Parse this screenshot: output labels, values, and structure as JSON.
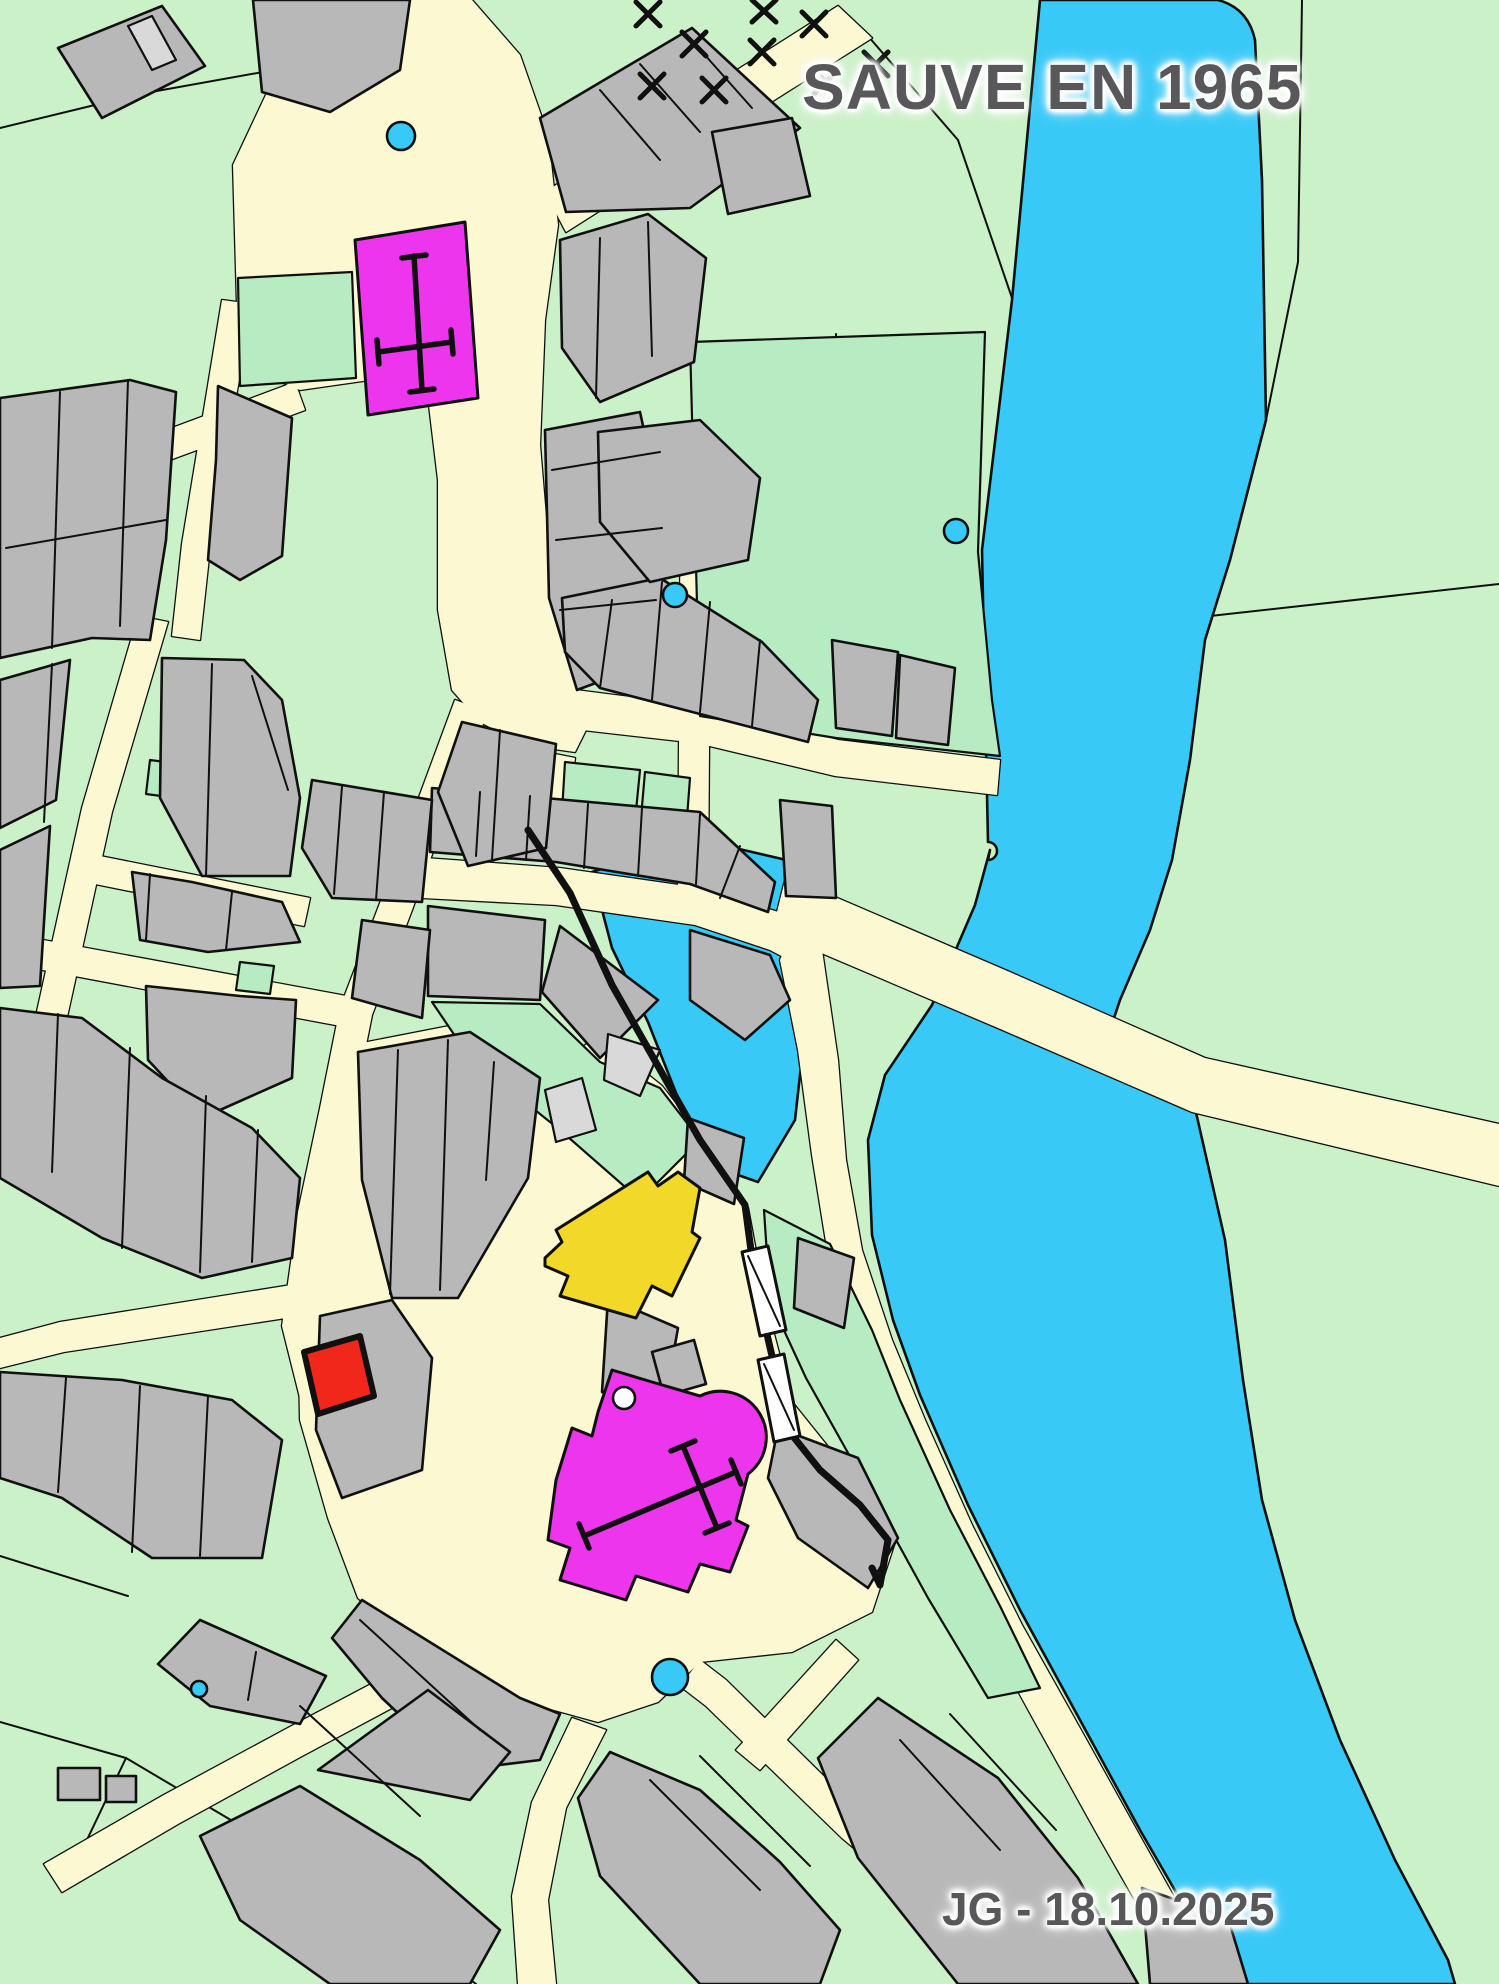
{
  "title": {
    "text": "SAUVE EN 1965"
  },
  "signature": {
    "text": "JG - 18.10.2025"
  },
  "colors": {
    "field-green": "#cbf1c8",
    "garden-green": "#b7ecc3",
    "road-cream": "#fbf8d2",
    "building-gray": "#b8b8b8",
    "building-light": "#d9d9d9",
    "water-blue": "#38c9f7",
    "church-magenta": "#ee35ee",
    "landmark-yellow": "#f2d929",
    "landmark-red": "#f2271c",
    "outline-black": "#101010",
    "text-gray": "#58585a"
  },
  "features": [
    {
      "name": "river",
      "color_key": "water-blue"
    },
    {
      "name": "mill-pond-cove",
      "color_key": "water-blue"
    },
    {
      "name": "bridge-road",
      "color_key": "road-cream"
    },
    {
      "name": "north-church",
      "color_key": "church-magenta",
      "symbol": "latin-cross"
    },
    {
      "name": "main-church",
      "color_key": "church-magenta",
      "symbol": "latin-cross"
    },
    {
      "name": "yellow-building",
      "color_key": "landmark-yellow"
    },
    {
      "name": "red-building",
      "color_key": "landmark-red"
    },
    {
      "name": "rampart-wall",
      "color_key": "outline-black"
    },
    {
      "name": "staircase-symbols",
      "color_key": "white",
      "count": 2
    },
    {
      "name": "fountain-dots",
      "color_key": "water-blue",
      "count": 5,
      "positions": [
        [
          401,
          136
        ],
        [
          675,
          595
        ],
        [
          956,
          531
        ],
        [
          670,
          1677
        ],
        [
          199,
          1689
        ]
      ]
    },
    {
      "name": "orchard-x-marks",
      "symbol": "x-cross",
      "count": 9
    }
  ]
}
